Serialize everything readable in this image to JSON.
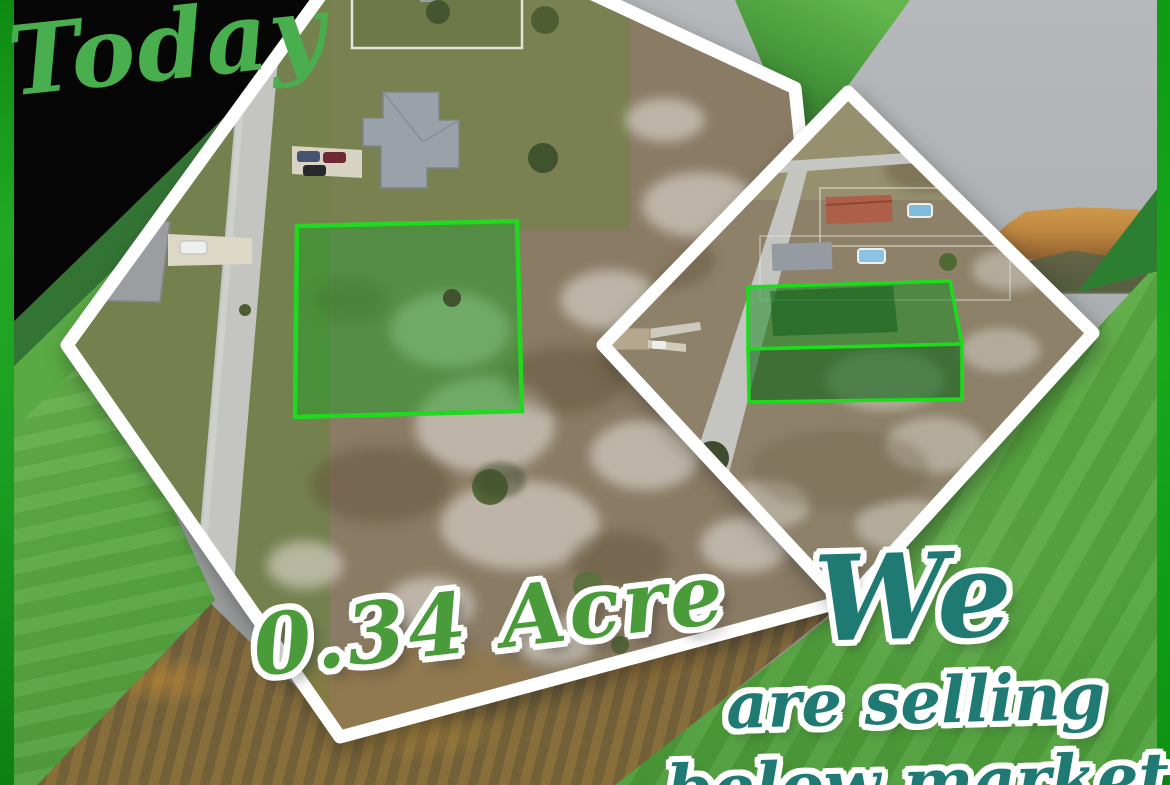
{
  "flyer": {
    "badge": {
      "text": "Today"
    },
    "main_photo": {
      "description": "top-down aerial photo of vacant residential lot",
      "area_label": "0.34 Acre",
      "lot_outline_color": "#22d922"
    },
    "secondary_photo": {
      "description": "oblique aerial photo of street with highlighted lot",
      "lot_outline_color": "#1ade1a"
    },
    "promo": {
      "line1": "We",
      "line2": "are selling",
      "line3": "below market"
    },
    "colors": {
      "brand_green_bright": "#17a81d",
      "brand_green_medium": "#54a53e",
      "brand_green_dark": "#2c6d2e",
      "script_green": "#49ae4e",
      "acre_green": "#4a9c3b",
      "promo_teal": "#1f7a74",
      "frame_white": "#ffffff",
      "backdrop_black": "#060606"
    }
  }
}
